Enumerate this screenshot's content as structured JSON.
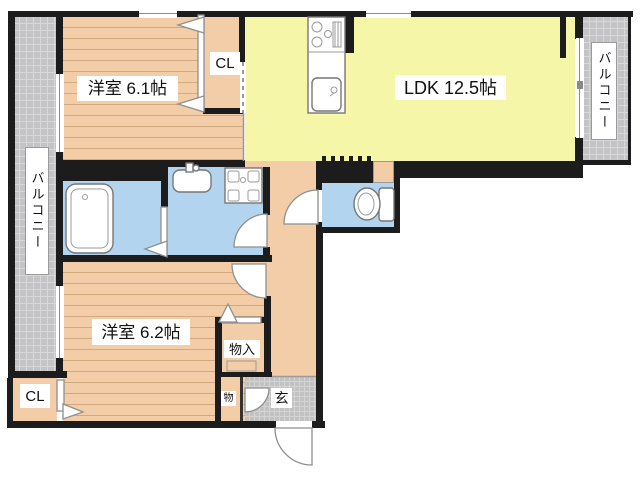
{
  "labels": {
    "bedroom1": "洋室 6.1帖",
    "ldk": "LDK 12.5帖",
    "bedroom2": "洋室 6.2帖",
    "closet1": "CL",
    "closet2": "CL",
    "storage": "物入",
    "small_storage": "物",
    "entrance": "玄",
    "balcony_left": "バルコニー",
    "balcony_right": "バルコニー"
  },
  "colors": {
    "wall": "#1c1c1c",
    "wood_floor": "#f2cda7",
    "wood_line": "#d2a87f",
    "ldk_yellow": "#f6f6a8",
    "wet_blue": "#b3d4ef",
    "balcony_gray": "#c4c4c7",
    "balcony_grid": "#d8d8da",
    "tile_gray": "#c2c2c2",
    "tile_grid": "#d4d4d4",
    "fixture_stroke": "#777777",
    "label_text": "#111111"
  }
}
